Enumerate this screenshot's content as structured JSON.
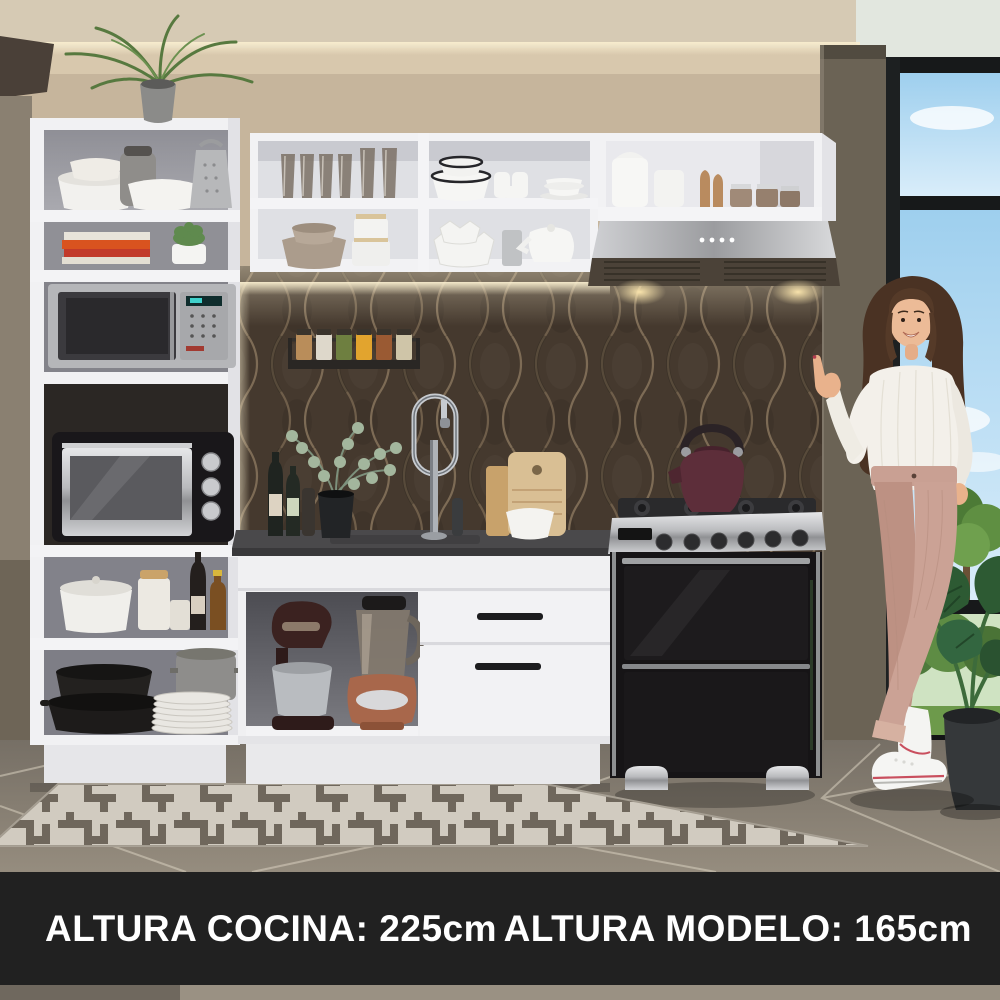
{
  "footer": {
    "left_caption": "ALTURA COCINA: 225cm",
    "right_caption": "ALTURA MODELO: 165cm",
    "background": "#212121",
    "text_color": "#ffffff"
  },
  "palette": {
    "ceiling": "#d6cab4",
    "wall": "#c6b59c",
    "wall_column": "#6b6355",
    "backsplash": "#45392e",
    "cabinet_white": "#f1f1f3",
    "countertop": "#4a494b",
    "floor": "#938a7c",
    "rug_base": "#d9d4c9",
    "rug_pattern": "#6f685d",
    "sky": "#a7d4f0",
    "foliage": "#4e7a3c",
    "stove_black": "#161416",
    "stainless": "#b9babd",
    "kettle": "#5d2e3a",
    "blender_copper": "#a8674b",
    "model_pants": "#c9a093",
    "model_sweater": "#f3f0ea",
    "model_hair": "#4a3223"
  }
}
